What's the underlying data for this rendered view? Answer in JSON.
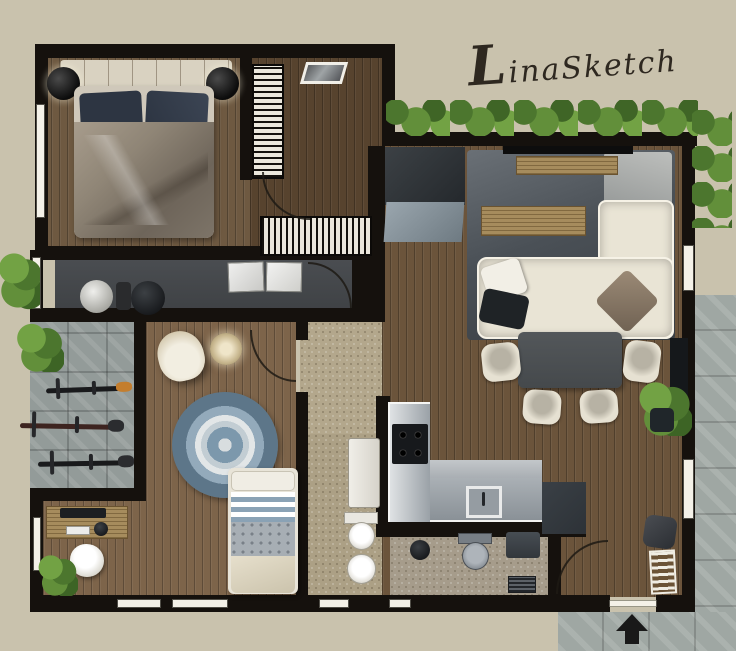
{
  "signature": {
    "text": "LinaSketch"
  },
  "palette": {
    "bg": "#c9c2ad",
    "wall": "#15110d",
    "window": "#f4f1e8",
    "wood_master": "#6e5941",
    "wood_dressing": "#57432e",
    "wood_living": "#6b543b",
    "wood_kids": "#7d644a",
    "stone_hall": "#b3a78c",
    "stone_bath": "#aca085",
    "stone_bath2": "#a69c8b",
    "corridor_floor": "#3f4245",
    "balcony_tile": "#939b99",
    "outside_tile": "#9fa7a3",
    "rug_dark": "#383d42",
    "rug_light": "#6a7076",
    "sofa_cream": "#e9e4d5",
    "pillow_navy": "#2d3542",
    "duvet_taupe": "#8f8576",
    "headboard_cream": "#d9d2c1",
    "furniture_wood": "#a68c5d",
    "counter_light": "#c6cacd",
    "counter_mid": "#8a9197",
    "unit_dark": "#2d3237",
    "table_dark": "#45494c",
    "chair_cream": "#e6e1d2",
    "hedge_dark": "#4c762e",
    "hedge_mid": "#628f3a",
    "hedge_light": "#72a244",
    "accent_orange": "#c47e2e",
    "kids_rug_blue": "#7c98ac",
    "stripe_blue": "#8aa2b5",
    "signature_ink": "#2e2820"
  },
  "inventory": {
    "master_bedroom": [
      "double-bed",
      "headboard",
      "nightstand-left",
      "nightstand-right",
      "wardrobe"
    ],
    "dressing_room": [
      "wardrobe-rail",
      "clothes-rack",
      "mirror"
    ],
    "corridor": [
      "round-stool-white",
      "round-stool-dark",
      "storage-cabinets"
    ],
    "living_room": [
      "tv",
      "tv-console",
      "coffee-table",
      "corner-sofa",
      "pillows",
      "rug",
      "entry-closet",
      "entry-mat"
    ],
    "dining_area": [
      "dining-table",
      "chairs-x4",
      "potted-plant"
    ],
    "kitchen": [
      "l-counter",
      "hob-4-burners",
      "sink",
      "tall-unit"
    ],
    "kids_room": [
      "single-bed",
      "round-rug",
      "armchair",
      "side-table"
    ],
    "study_nook": [
      "desk",
      "monitor",
      "keyboard",
      "desk-chair",
      "plant"
    ],
    "balcony": [
      "bicycle-x3",
      "bushes"
    ],
    "bathroom_left": [
      "vanity",
      "toilet",
      "bidet"
    ],
    "bathroom_right": [
      "toilet",
      "wall-sink",
      "stool",
      "shower-drain"
    ],
    "entrance": [
      "bench",
      "shoe-rack",
      "door-arc",
      "direction-arrow"
    ]
  }
}
